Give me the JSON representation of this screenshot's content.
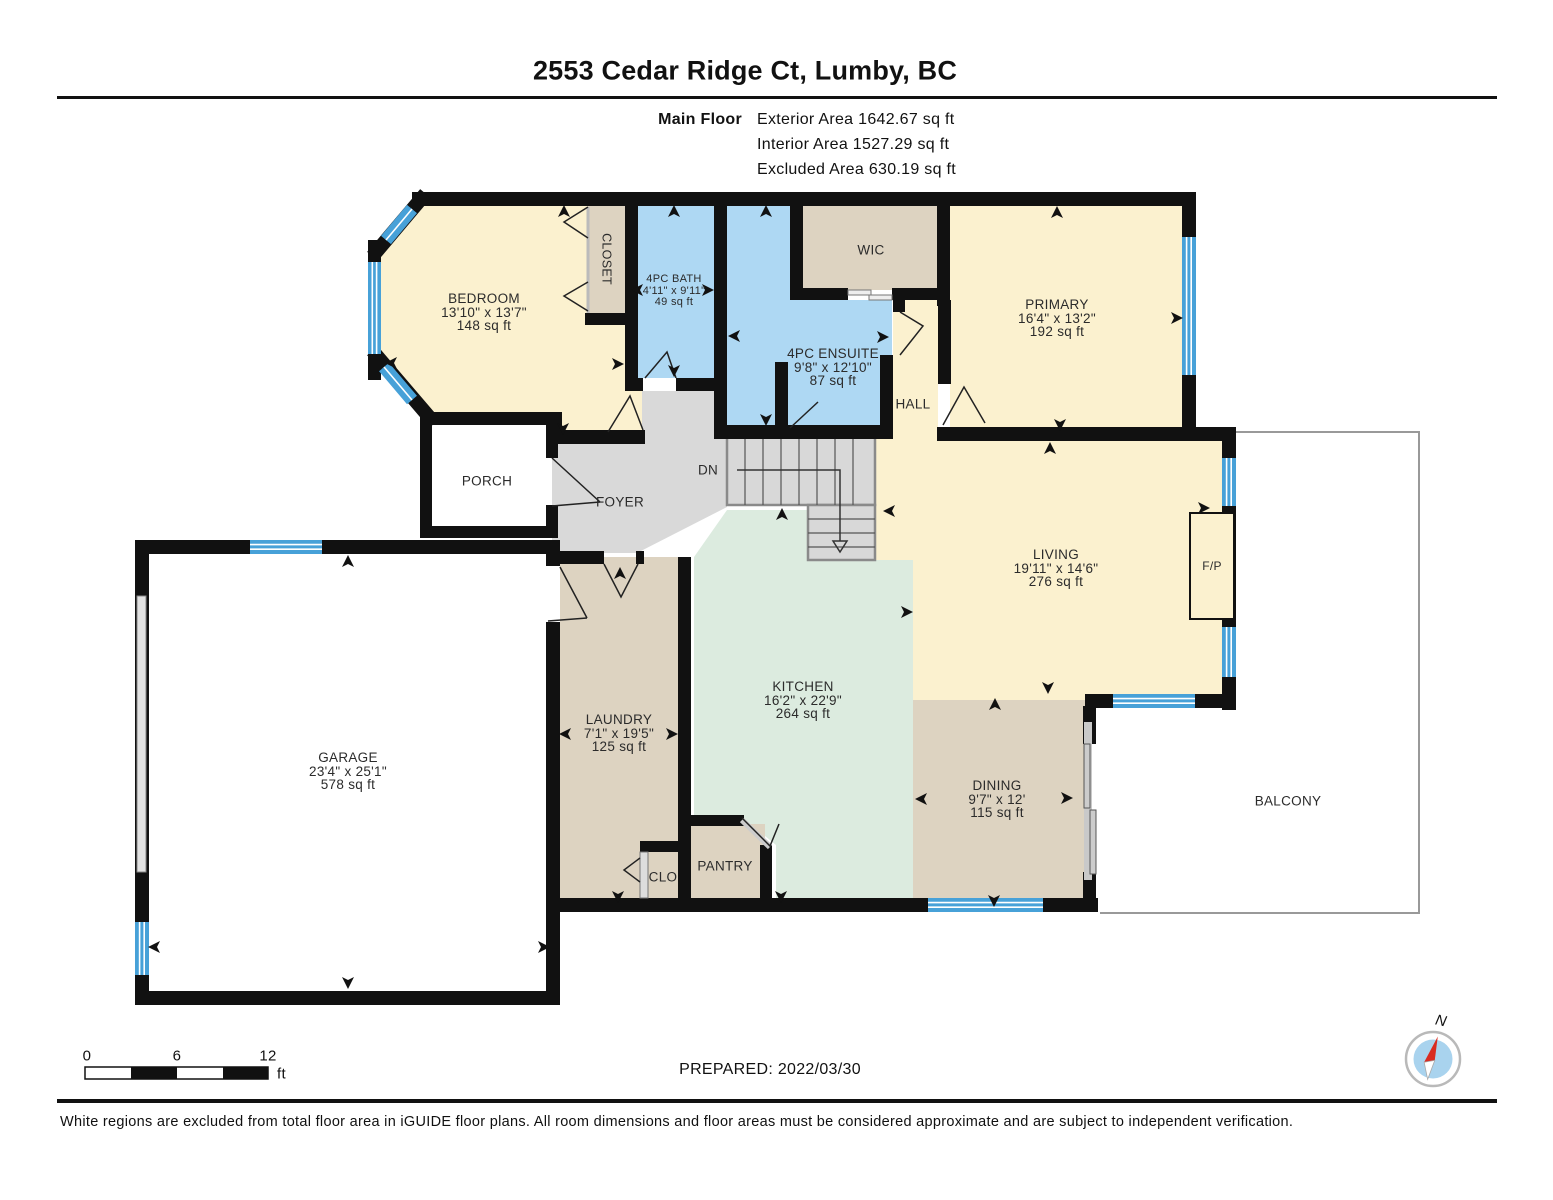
{
  "header": {
    "title": "2553 Cedar Ridge Ct, Lumby, BC",
    "floor_label": "Main Floor",
    "stats": [
      "Exterior Area 1642.67 sq ft",
      "Interior Area 1527.29 sq ft",
      "Excluded Area 630.19 sq ft"
    ]
  },
  "rooms": {
    "bedroom": {
      "name": "BEDROOM",
      "dims": "13'10\" x 13'7\"",
      "area": "148 sq ft"
    },
    "bath": {
      "name": "4PC BATH",
      "dims": "4'11\" x 9'11\"",
      "area": "49 sq ft"
    },
    "ensuite": {
      "name": "4PC ENSUITE",
      "dims": "9'8\" x 12'10\"",
      "area": "87 sq ft"
    },
    "primary": {
      "name": "PRIMARY",
      "dims": "16'4\" x 13'2\"",
      "area": "192 sq ft"
    },
    "living": {
      "name": "LIVING",
      "dims": "19'11\" x 14'6\"",
      "area": "276 sq ft"
    },
    "kitchen": {
      "name": "KITCHEN",
      "dims": "16'2\" x 22'9\"",
      "area": "264 sq ft"
    },
    "laundry": {
      "name": "LAUNDRY",
      "dims": "7'1\" x 19'5\"",
      "area": "125 sq ft"
    },
    "dining": {
      "name": "DINING",
      "dims": "9'7\" x 12'",
      "area": "115 sq ft"
    },
    "garage": {
      "name": "GARAGE",
      "dims": "23'4\" x 25'1\"",
      "area": "578 sq ft"
    }
  },
  "areas": {
    "closet": "CLOSET",
    "wic": "WIC",
    "hall": "HALL",
    "porch": "PORCH",
    "foyer": "FOYER",
    "clo": "CLO",
    "pantry": "PANTRY",
    "balcony": "BALCONY",
    "stairs_down": "DN",
    "fireplace": "F/P"
  },
  "footer": {
    "scale": {
      "start": "0",
      "mid": "6",
      "end": "12",
      "unit": "ft"
    },
    "prepared": "PREPARED: 2022/03/30",
    "compass_north": "N",
    "disclaimer": "White regions are excluded from total floor area in iGUIDE floor plans. All room dimensions and floor areas must be considered approximate and are subject to independent verification."
  },
  "icons": {
    "direction_arrow": "triangle-marker",
    "compass": "compass-rose-icon"
  },
  "colors": {
    "wall": "#111111",
    "room_cream": "#fbf1cf",
    "room_blue": "#aed8f3",
    "room_tan": "#ddd3c1",
    "room_mint": "#dcebdf",
    "floor_gray": "#d9d9d9",
    "window_blue": "#47a1d8",
    "excluded_white": "#ffffff"
  }
}
